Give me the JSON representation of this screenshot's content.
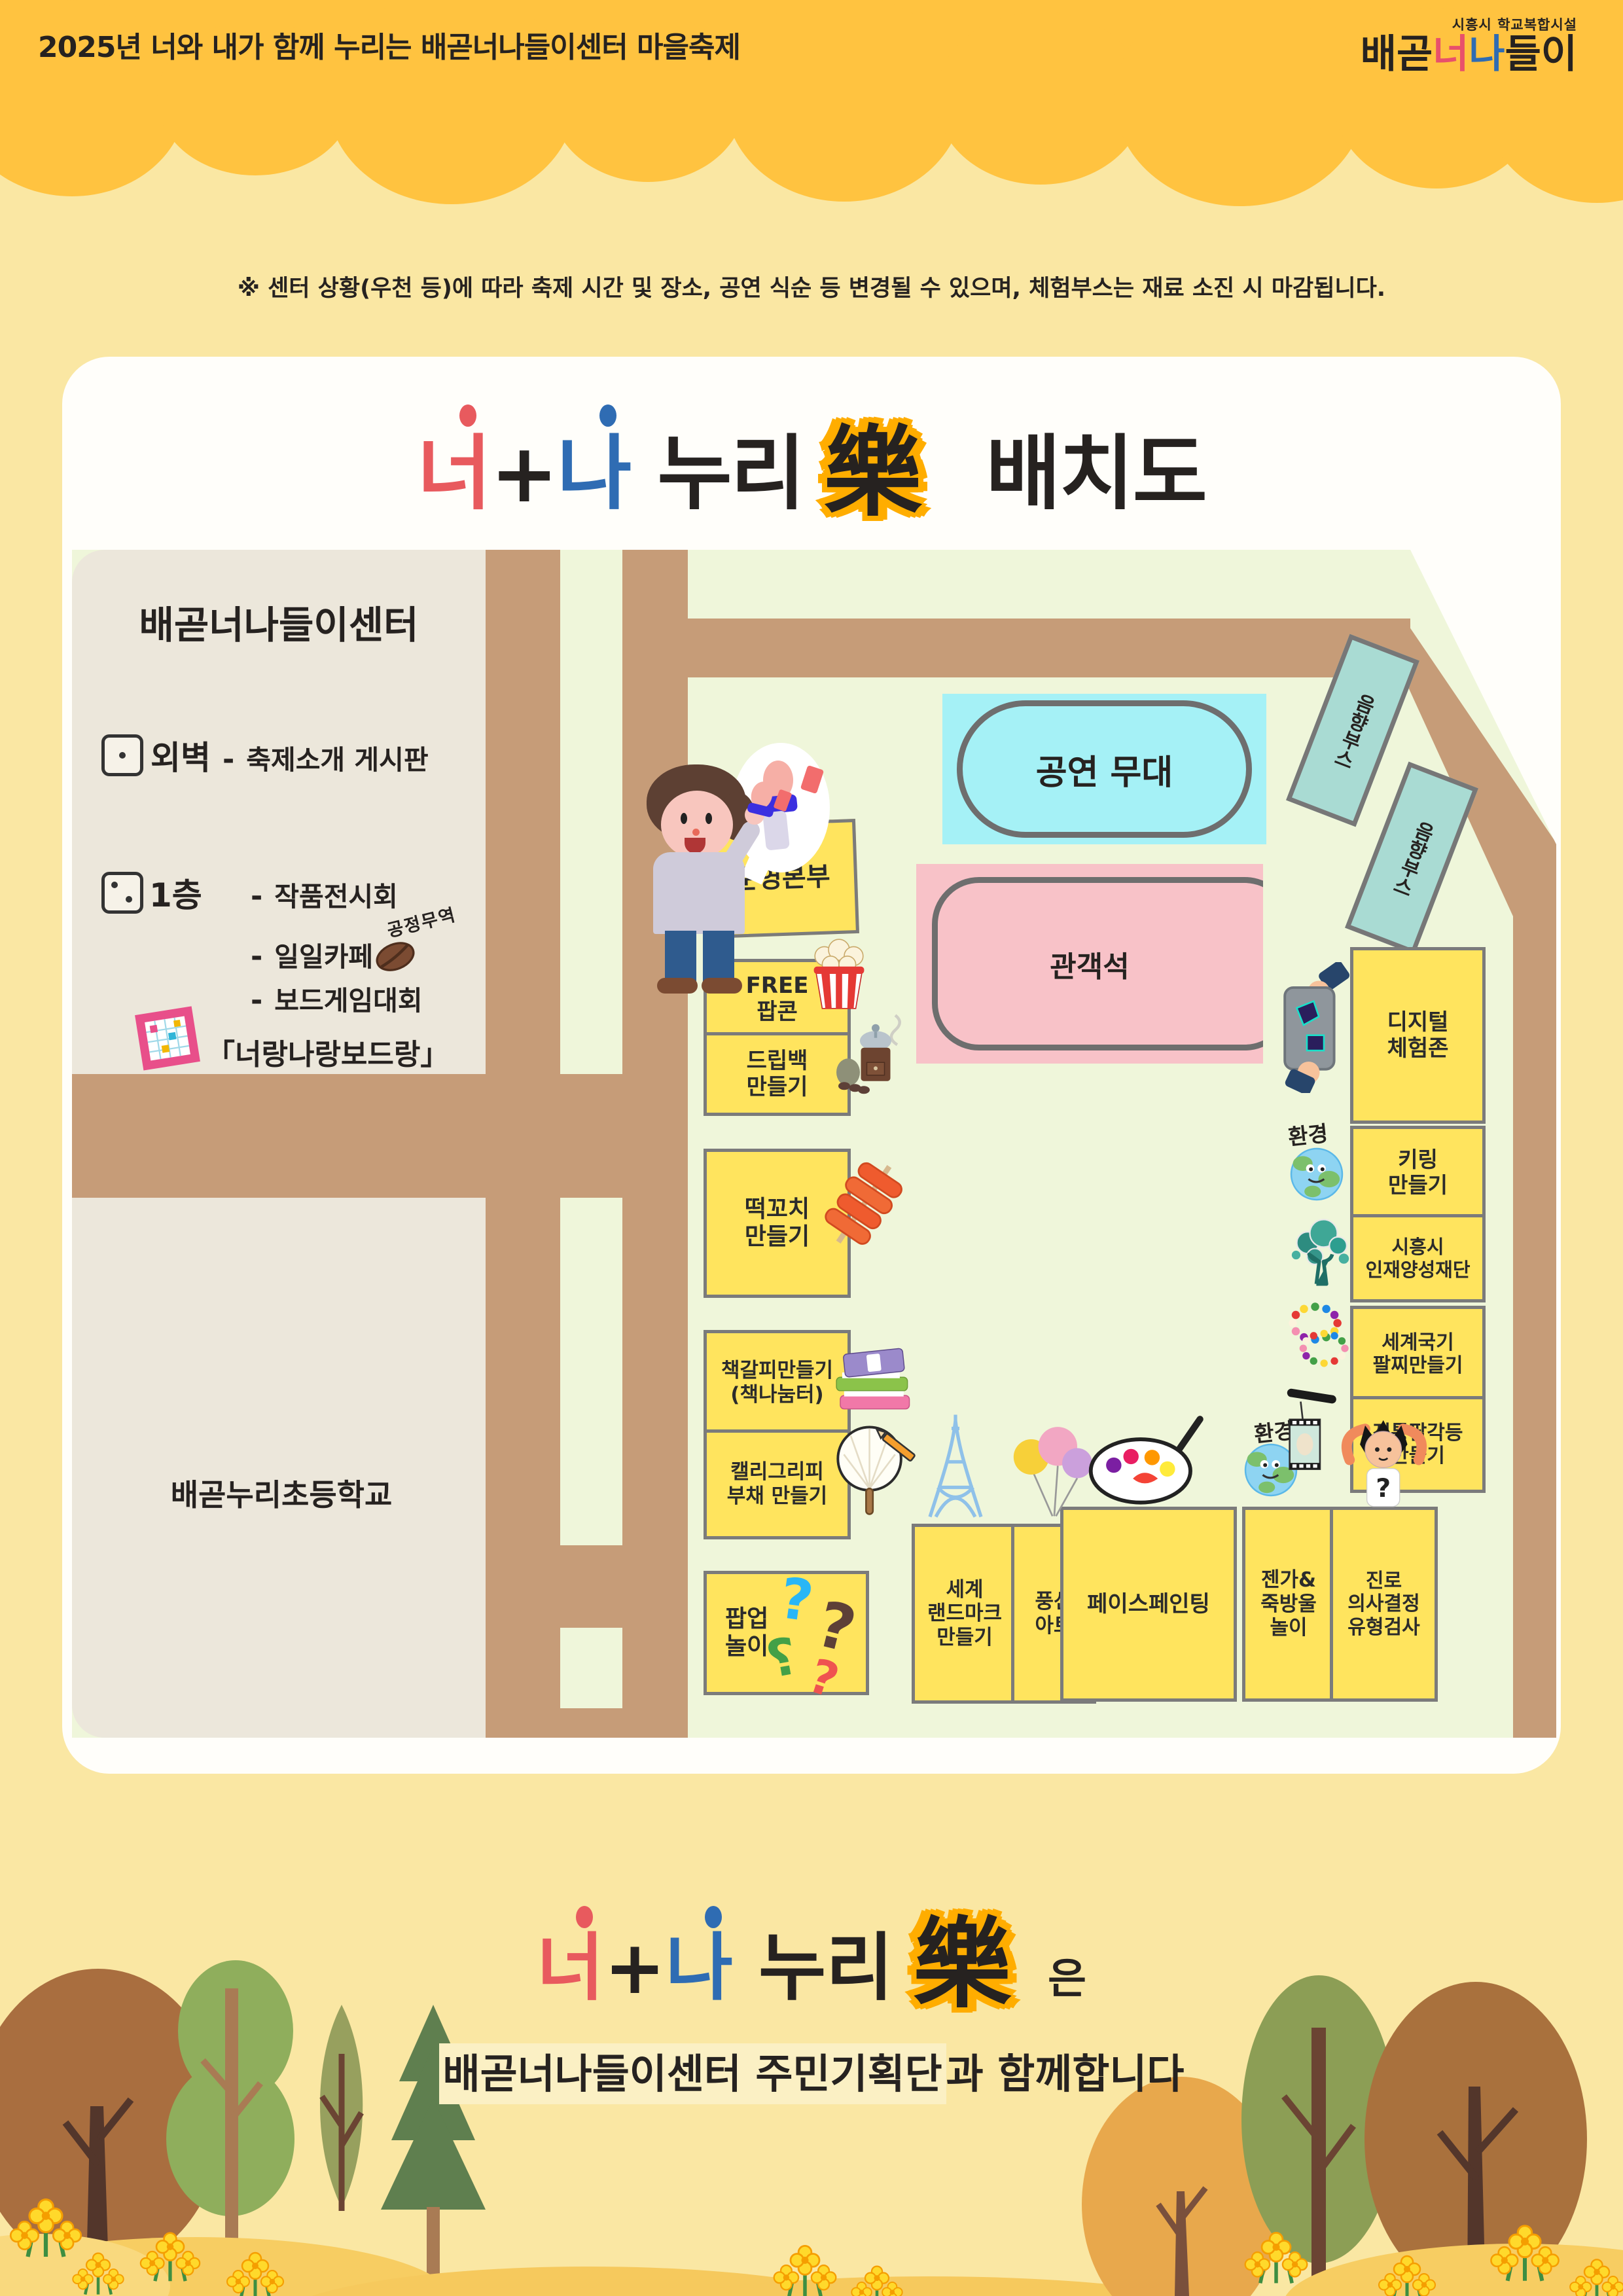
{
  "header": {
    "title": "2025년 너와 내가 함께 누리는 배곧너나들이센터 마을축제",
    "logo": {
      "facility": "시흥시 학교복합시설",
      "p1": "배곧",
      "p2": "너",
      "p3": "나",
      "p4": "들이"
    }
  },
  "notice": "※ 센터 상황(우천 등)에 따라 축제 시간 및 장소, 공연 식순 등 변경될 수 있으며, 체험부스는 재료 소진 시 마감됩니다.",
  "map_title": {
    "you": "너",
    "plus": "+",
    "me": "나",
    "nuri": "누리",
    "rak": "樂",
    "suffix": "배치도"
  },
  "map": {
    "center_name": "배곧너나들이센터",
    "legend": {
      "dash": "-",
      "wall_label": "외벽",
      "wall_desc": "축제소개 게시판",
      "floor_label": "1층",
      "line1": "작품전시회",
      "line2": "일일카페",
      "cafe_note": "공정무역",
      "line3": "보드게임대회",
      "line4": "「너랑나랑보드랑」"
    },
    "school_name": "배곧누리초등학교",
    "stage_label": "공연 무대",
    "audience_label": "관객석",
    "sound_booth": "음향부스",
    "env_label": "환경",
    "qmark": "?",
    "booths": {
      "ops": "운영본부",
      "popcorn": "FREE\n팝콘",
      "dripbag": "드립백\n만들기",
      "tteok": "떡꼬치\n만들기",
      "bookmark": "책갈피만들기\n(책나눔터)",
      "calligraphy": "캘리그리피\n부채 만들기",
      "popup": "팝업\n놀이",
      "landmark": "세계\n랜드마크\n만들기",
      "balloon": "풍선\n아트",
      "facepaint": "페이스페인팅",
      "jenga": "젠가&\n죽방울\n놀이",
      "career": "진로\n의사결정\n유형검사",
      "digital": "디지털\n체험존",
      "keyring": "키링\n만들기",
      "foundation": "시흥시\n인재양성재단",
      "flagband": "세계국기\n팔찌만들기",
      "lantern": "전통팔각등\n만들기"
    }
  },
  "footer": {
    "eun": "은",
    "highlight": "배곧너나들이센터 주민기획단",
    "rest": "과 함께합니다"
  },
  "colors": {
    "header_bg": "#FFC340",
    "page_bg": "#FAE7A3",
    "card_bg": "#FFFEFA",
    "map_green": "#EFF6DA",
    "road": "#C69C78",
    "building": "#ECE7DB",
    "booth_yellow": "#FFE45E",
    "stage_cyan": "#A5F1F6",
    "audience_pink": "#F8C2C8",
    "sound_teal": "#A9DBD3",
    "title_red": "#E85A5E",
    "title_blue": "#2F6CB3",
    "rak_halo": "#FFAD00"
  }
}
